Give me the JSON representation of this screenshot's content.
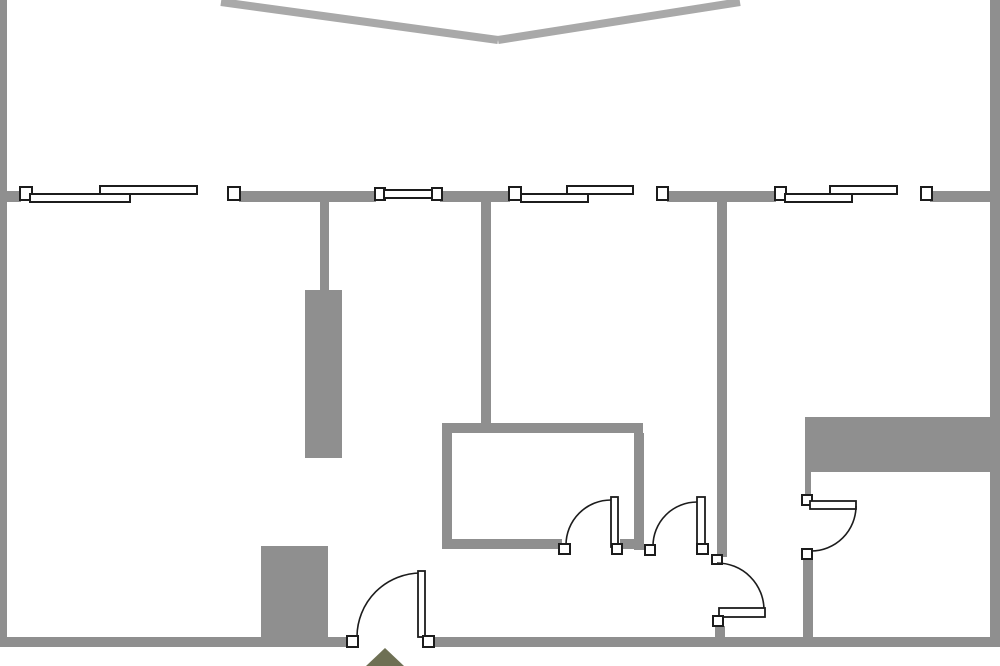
{
  "canvas": {
    "width": 1000,
    "height": 666,
    "background": "#ffffff"
  },
  "palette": {
    "wall": "#8f8f8f",
    "terrace": "#a9a9a9",
    "fixture_stroke": "#1c1c1c",
    "fixture_fill": "#ffffff",
    "marker": "#6e7054"
  },
  "elements": [
    {
      "name": "terrace-edge-left",
      "kind": "line",
      "interactable": false,
      "x1": 221,
      "y1": 2,
      "x2": 498,
      "y2": 40,
      "stroke": "terrace",
      "width": 8
    },
    {
      "name": "terrace-edge-right",
      "kind": "line",
      "interactable": false,
      "x1": 498,
      "y1": 40,
      "x2": 740,
      "y2": 2,
      "stroke": "terrace",
      "width": 8
    },
    {
      "name": "wall-exterior-left",
      "kind": "wall",
      "interactable": false,
      "rect": [
        0,
        0,
        7,
        647
      ]
    },
    {
      "name": "wall-exterior-right",
      "kind": "wall",
      "interactable": false,
      "rect": [
        990,
        0,
        10,
        647
      ]
    },
    {
      "name": "wall-bottom-west",
      "kind": "wall",
      "interactable": false,
      "rect": [
        0,
        637,
        349,
        10
      ]
    },
    {
      "name": "wall-bottom-east",
      "kind": "wall",
      "interactable": false,
      "rect": [
        430,
        637,
        570,
        10
      ]
    },
    {
      "name": "wall-front-stub",
      "kind": "wall",
      "interactable": false,
      "rect": [
        0,
        191,
        21,
        11
      ]
    },
    {
      "name": "wall-front-a",
      "kind": "wall",
      "interactable": false,
      "rect": [
        239,
        191,
        137,
        11
      ]
    },
    {
      "name": "wall-front-b",
      "kind": "wall",
      "interactable": false,
      "rect": [
        440,
        191,
        70,
        11
      ]
    },
    {
      "name": "wall-front-c",
      "kind": "wall",
      "interactable": false,
      "rect": [
        667,
        191,
        109,
        11
      ]
    },
    {
      "name": "wall-front-d",
      "kind": "wall",
      "interactable": false,
      "rect": [
        930,
        191,
        70,
        11
      ]
    },
    {
      "name": "wall-interior-a",
      "kind": "wall",
      "interactable": false,
      "rect": [
        320,
        202,
        9,
        89
      ]
    },
    {
      "name": "column-block",
      "kind": "wall",
      "interactable": true,
      "rect": [
        305,
        290,
        37,
        168
      ]
    },
    {
      "name": "wall-interior-b",
      "kind": "wall",
      "interactable": false,
      "rect": [
        481,
        202,
        10,
        221
      ]
    },
    {
      "name": "wall-interior-c",
      "kind": "wall",
      "interactable": false,
      "rect": [
        717,
        202,
        10,
        355
      ]
    },
    {
      "name": "wall-interior-c-stub",
      "kind": "wall",
      "interactable": false,
      "rect": [
        715,
        626,
        10,
        11
      ]
    },
    {
      "name": "room-wall-top",
      "kind": "wall",
      "interactable": false,
      "rect": [
        442,
        423,
        201,
        10
      ]
    },
    {
      "name": "room-wall-left",
      "kind": "wall",
      "interactable": false,
      "rect": [
        442,
        433,
        10,
        116
      ]
    },
    {
      "name": "room-wall-right",
      "kind": "wall",
      "interactable": false,
      "rect": [
        634,
        433,
        10,
        117
      ]
    },
    {
      "name": "room-wall-bottom-west",
      "kind": "wall",
      "interactable": false,
      "rect": [
        452,
        539,
        110,
        10
      ]
    },
    {
      "name": "room-wall-bottom-east",
      "kind": "wall",
      "interactable": false,
      "rect": [
        620,
        539,
        14,
        10
      ]
    },
    {
      "name": "storage-block",
      "kind": "wall",
      "interactable": true,
      "rect": [
        261,
        546,
        67,
        91
      ]
    },
    {
      "name": "closet-block",
      "kind": "wall",
      "interactable": true,
      "rect": [
        805,
        417,
        185,
        55
      ]
    },
    {
      "name": "closet-stub",
      "kind": "wall",
      "interactable": false,
      "rect": [
        805,
        472,
        6,
        24
      ]
    },
    {
      "name": "wall-right-door-lower",
      "kind": "wall",
      "interactable": false,
      "rect": [
        803,
        558,
        10,
        79
      ]
    },
    {
      "name": "window-1-cap-left",
      "kind": "cap",
      "interactable": true,
      "rect": [
        20,
        187,
        12,
        13
      ]
    },
    {
      "name": "window-1-pane-lower",
      "kind": "pane",
      "interactable": true,
      "rect": [
        30,
        194,
        100,
        8
      ]
    },
    {
      "name": "window-1-pane-upper",
      "kind": "pane",
      "interactable": true,
      "rect": [
        100,
        186,
        97,
        8
      ]
    },
    {
      "name": "window-1-cap-right",
      "kind": "cap",
      "interactable": true,
      "rect": [
        228,
        187,
        12,
        13
      ]
    },
    {
      "name": "window-2-cap-left",
      "kind": "cap",
      "interactable": true,
      "rect": [
        375,
        188,
        10,
        12
      ]
    },
    {
      "name": "window-2-glass",
      "kind": "pane",
      "interactable": true,
      "rect": [
        384,
        190,
        49,
        8
      ]
    },
    {
      "name": "window-2-cap-right",
      "kind": "cap",
      "interactable": true,
      "rect": [
        432,
        188,
        10,
        12
      ]
    },
    {
      "name": "window-3-cap-left",
      "kind": "cap",
      "interactable": true,
      "rect": [
        509,
        187,
        12,
        13
      ]
    },
    {
      "name": "window-3-pane-lower",
      "kind": "pane",
      "interactable": true,
      "rect": [
        521,
        194,
        67,
        8
      ]
    },
    {
      "name": "window-3-pane-upper",
      "kind": "pane",
      "interactable": true,
      "rect": [
        567,
        186,
        66,
        8
      ]
    },
    {
      "name": "window-3-cap-right",
      "kind": "cap",
      "interactable": true,
      "rect": [
        657,
        187,
        11,
        13
      ]
    },
    {
      "name": "window-4-cap-left",
      "kind": "cap",
      "interactable": true,
      "rect": [
        775,
        187,
        11,
        13
      ]
    },
    {
      "name": "window-4-pane-lower",
      "kind": "pane",
      "interactable": true,
      "rect": [
        785,
        194,
        67,
        8
      ]
    },
    {
      "name": "window-4-pane-upper",
      "kind": "pane",
      "interactable": true,
      "rect": [
        830,
        186,
        67,
        8
      ]
    },
    {
      "name": "window-4-cap-right",
      "kind": "cap",
      "interactable": true,
      "rect": [
        921,
        187,
        11,
        13
      ]
    },
    {
      "name": "door-1-jamb-left",
      "kind": "cap",
      "interactable": true,
      "rect": [
        347,
        636,
        11,
        11
      ]
    },
    {
      "name": "door-1-swing",
      "kind": "arc",
      "interactable": true,
      "d": "M 357 637 A 64 64 0 0 1 421 573"
    },
    {
      "name": "door-1-leaf",
      "kind": "leaf",
      "interactable": true,
      "rect": [
        418,
        571,
        7,
        66
      ]
    },
    {
      "name": "door-1-jamb-right",
      "kind": "cap",
      "interactable": true,
      "rect": [
        423,
        636,
        11,
        11
      ]
    },
    {
      "name": "door-2-jamb-left",
      "kind": "cap",
      "interactable": true,
      "rect": [
        559,
        544,
        11,
        10
      ]
    },
    {
      "name": "door-2-swing",
      "kind": "arc",
      "interactable": true,
      "d": "M 566 545 A 45 45 0 0 1 611 500"
    },
    {
      "name": "door-2-leaf",
      "kind": "leaf",
      "interactable": true,
      "rect": [
        611,
        497,
        7,
        50
      ]
    },
    {
      "name": "door-2-jamb-right",
      "kind": "cap",
      "interactable": true,
      "rect": [
        612,
        544,
        10,
        10
      ]
    },
    {
      "name": "door-3-jamb-left",
      "kind": "cap",
      "interactable": true,
      "rect": [
        645,
        545,
        10,
        10
      ]
    },
    {
      "name": "door-3-swing",
      "kind": "arc",
      "interactable": true,
      "d": "M 653 546 A 44 44 0 0 1 697 502"
    },
    {
      "name": "door-3-leaf",
      "kind": "leaf",
      "interactable": true,
      "rect": [
        697,
        497,
        8,
        50
      ]
    },
    {
      "name": "door-3-jamb-right",
      "kind": "cap",
      "interactable": true,
      "rect": [
        697,
        544,
        11,
        10
      ]
    },
    {
      "name": "door-4-jamb-top",
      "kind": "cap",
      "interactable": true,
      "rect": [
        712,
        555,
        10,
        9
      ]
    },
    {
      "name": "door-4-swing",
      "kind": "arc",
      "interactable": true,
      "d": "M 717 563 A 47 47 0 0 1 764 610"
    },
    {
      "name": "door-4-leaf",
      "kind": "leaf",
      "interactable": true,
      "rect": [
        719,
        608,
        46,
        9
      ]
    },
    {
      "name": "door-4-jamb-bottom",
      "kind": "cap",
      "interactable": true,
      "rect": [
        713,
        616,
        10,
        10
      ]
    },
    {
      "name": "door-5-jamb-top",
      "kind": "cap",
      "interactable": true,
      "rect": [
        802,
        495,
        10,
        10
      ]
    },
    {
      "name": "door-5-leaf",
      "kind": "leaf",
      "interactable": true,
      "rect": [
        810,
        501,
        46,
        8
      ]
    },
    {
      "name": "door-5-swing",
      "kind": "arc",
      "interactable": true,
      "d": "M 856 506 A 45 45 0 0 1 811 551"
    },
    {
      "name": "door-5-jamb-bottom",
      "kind": "cap",
      "interactable": true,
      "rect": [
        802,
        549,
        10,
        10
      ]
    },
    {
      "name": "entrance-marker",
      "kind": "polygon",
      "interactable": true,
      "points": "385,648 366,666 404,666",
      "fill": "marker"
    }
  ]
}
